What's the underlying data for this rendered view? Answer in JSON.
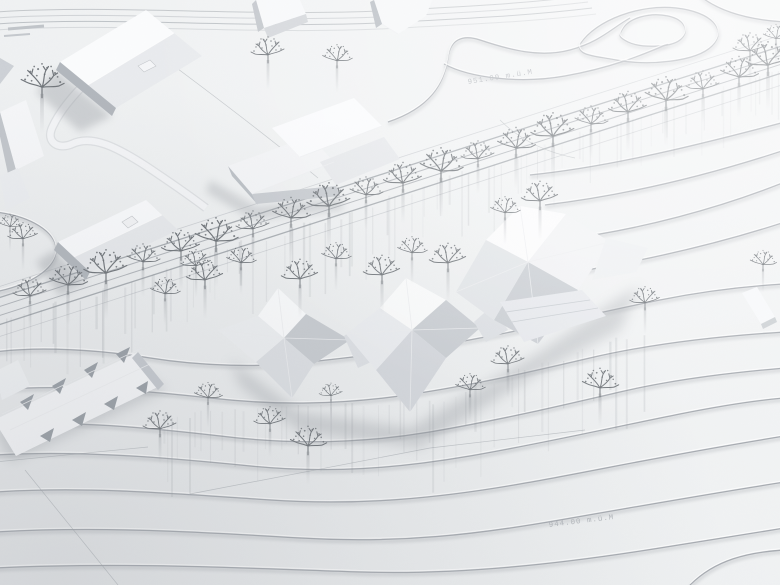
{
  "photo": {
    "subject": "white architectural site model, aerial view",
    "labels": {
      "upper_elevation": "951.00 m.ü.M",
      "lower_elevation": "944.00 m.ü.M"
    },
    "palette": {
      "paper": "#eef0f2",
      "paper_bright": "#f7f8f9",
      "paper_shade": "#e6e8ea",
      "contour": "#a4a9af",
      "facet_white": "#fbfcfd",
      "facet_light": "#eceef1",
      "facet_mid": "#d3d6db",
      "facet_dark": "#c6cacf",
      "facade_dark": "#b0b5bc",
      "tree": "#6e7378",
      "shadow": "#8d9298",
      "label_text": "#b3b7bc"
    }
  },
  "scene": {
    "trees": {
      "avenue": [
        [
          30,
          295
        ],
        [
          68,
          284
        ],
        [
          106,
          272
        ],
        [
          143,
          261
        ],
        [
          181,
          250
        ],
        [
          216,
          240
        ],
        [
          253,
          228
        ],
        [
          291,
          217
        ],
        [
          329,
          205
        ],
        [
          366,
          194
        ],
        [
          403,
          182
        ],
        [
          441,
          170
        ],
        [
          478,
          158
        ],
        [
          516,
          147
        ],
        [
          553,
          135
        ],
        [
          591,
          123
        ],
        [
          628,
          111
        ],
        [
          666,
          99
        ],
        [
          703,
          88
        ],
        [
          739,
          76
        ],
        [
          768,
          64
        ]
      ],
      "avenue_lower": [
        [
          165,
          293
        ],
        [
          205,
          279
        ],
        [
          241,
          262
        ],
        [
          300,
          278
        ],
        [
          336,
          258
        ],
        [
          382,
          274
        ],
        [
          412,
          252
        ],
        [
          448,
          262
        ],
        [
          505,
          212
        ],
        [
          540,
          200
        ]
      ],
      "scattered": [
        [
          42,
          86,
          1.3
        ],
        [
          268,
          54,
          1
        ],
        [
          337,
          60,
          0.9
        ],
        [
          750,
          50,
          1
        ],
        [
          776,
          38,
          0.8
        ],
        [
          23,
          238,
          0.9
        ],
        [
          10,
          226,
          0.7
        ],
        [
          160,
          428,
          1
        ],
        [
          208,
          397,
          0.85
        ],
        [
          270,
          423,
          0.95
        ],
        [
          308,
          445,
          1.1
        ],
        [
          331,
          395,
          0.7
        ],
        [
          470,
          389,
          0.9
        ],
        [
          508,
          363,
          1
        ],
        [
          600,
          387,
          1.1
        ],
        [
          645,
          302,
          0.9
        ],
        [
          763,
          264,
          0.8
        ],
        [
          196,
          265,
          0.9
        ]
      ]
    },
    "streak_bands": [
      {
        "x0": -5,
        "y0": 320,
        "x1": 785,
        "y1": 68,
        "count": 85,
        "len": 52,
        "spread": 16
      },
      {
        "x0": 160,
        "y0": 412,
        "x1": 430,
        "y1": 396,
        "count": 26,
        "len": 58,
        "spread": 10
      },
      {
        "x0": 430,
        "y0": 398,
        "x1": 640,
        "y1": 328,
        "count": 20,
        "len": 66,
        "spread": 10
      }
    ]
  }
}
